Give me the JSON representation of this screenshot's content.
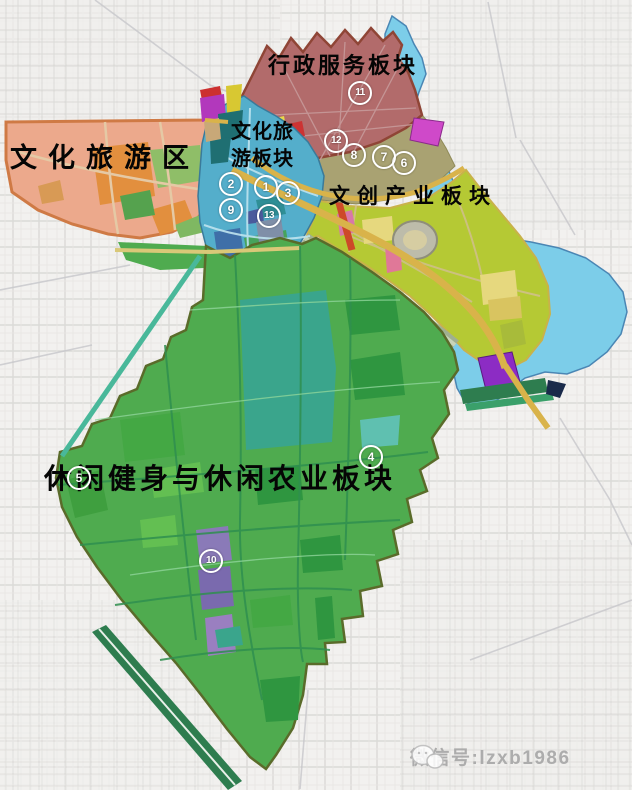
{
  "regions": {
    "admin": {
      "label": "行政服务板块",
      "color": "#b26b6b"
    },
    "tourism_zone": {
      "label": "文化旅游区",
      "color": "#eca98c"
    },
    "tourism_board": {
      "label_line1": "文化旅",
      "label_line2": "游板块",
      "color": "#54aecb"
    },
    "creative": {
      "label": "文创产业板块",
      "color": "#b5c934"
    },
    "leisure": {
      "label": "休闲健身与休闲农业板块",
      "color": "#4fab4f"
    }
  },
  "markers": [
    {
      "label": "1"
    },
    {
      "label": "2"
    },
    {
      "label": "3"
    },
    {
      "label": "4"
    },
    {
      "label": "5"
    },
    {
      "label": "6"
    },
    {
      "label": "7"
    },
    {
      "label": "8"
    },
    {
      "label": "9"
    },
    {
      "label": "10"
    },
    {
      "label": "11"
    },
    {
      "label": "12"
    },
    {
      "label": "13"
    }
  ],
  "watermark": {
    "text": "微信号:lzxb1986"
  },
  "colors": {
    "background": "#f2f1ef",
    "water": "#7ccde9",
    "water_edge": "#4a86b4",
    "road_major": "#d9b34a",
    "khaki_zone": "#a9a272",
    "admin_border": "#8f4536",
    "tourism_border": "#cf7a45",
    "leisure_border": "#5a6b2a",
    "teal_field": "#3aa58c",
    "purple_block": "#8c2cc4",
    "magenta_strip": "#cf49c9",
    "rail_green": "#2e7d4f"
  }
}
